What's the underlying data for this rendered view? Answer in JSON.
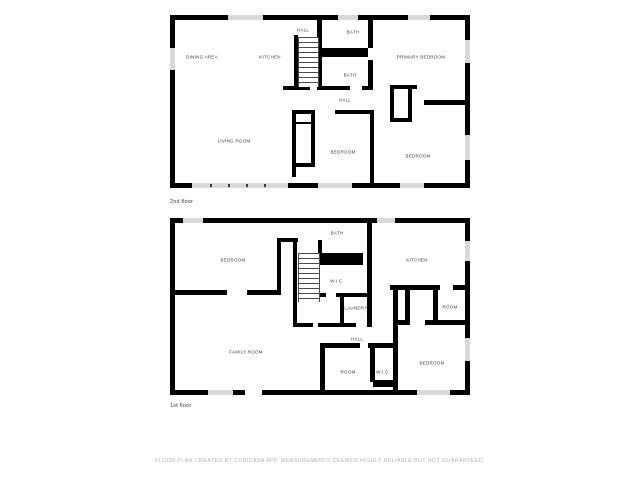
{
  "colors": {
    "wall": "#000000",
    "window": "#d9d9d9",
    "room_label": "#3a3a3a",
    "floor_label": "#3a3a3a",
    "footer": "#b3b3b3",
    "background": "#ffffff"
  },
  "floor2": {
    "name": "2nd floor",
    "rooms": [
      {
        "label": "DINING AREA"
      },
      {
        "label": "KITCHEN"
      },
      {
        "label": "HALL"
      },
      {
        "label": "BATH"
      },
      {
        "label": "BATH"
      },
      {
        "label": "PRIMARY BEDROOM"
      },
      {
        "label": "HALL"
      },
      {
        "label": "LIVING ROOM"
      },
      {
        "label": "BEDROOM"
      },
      {
        "label": "BEDROOM"
      }
    ]
  },
  "floor1": {
    "name": "1st floor",
    "rooms": [
      {
        "label": "BEDROOM"
      },
      {
        "label": "BATH"
      },
      {
        "label": "KITCHEN"
      },
      {
        "label": "W.I.C."
      },
      {
        "label": "LAUNDRY"
      },
      {
        "label": "ROOM"
      },
      {
        "label": "HALL"
      },
      {
        "label": "FAMILY ROOM"
      },
      {
        "label": "ROOM"
      },
      {
        "label": "W.I.C."
      },
      {
        "label": "BEDROOM"
      }
    ]
  },
  "footer": {
    "text": "FLOOR PLAN CREATED BY CUBICASA APP. MEASUREMENTS DEEMED HIGHLY RELIABLE BUT NOT GUARANTEED."
  }
}
